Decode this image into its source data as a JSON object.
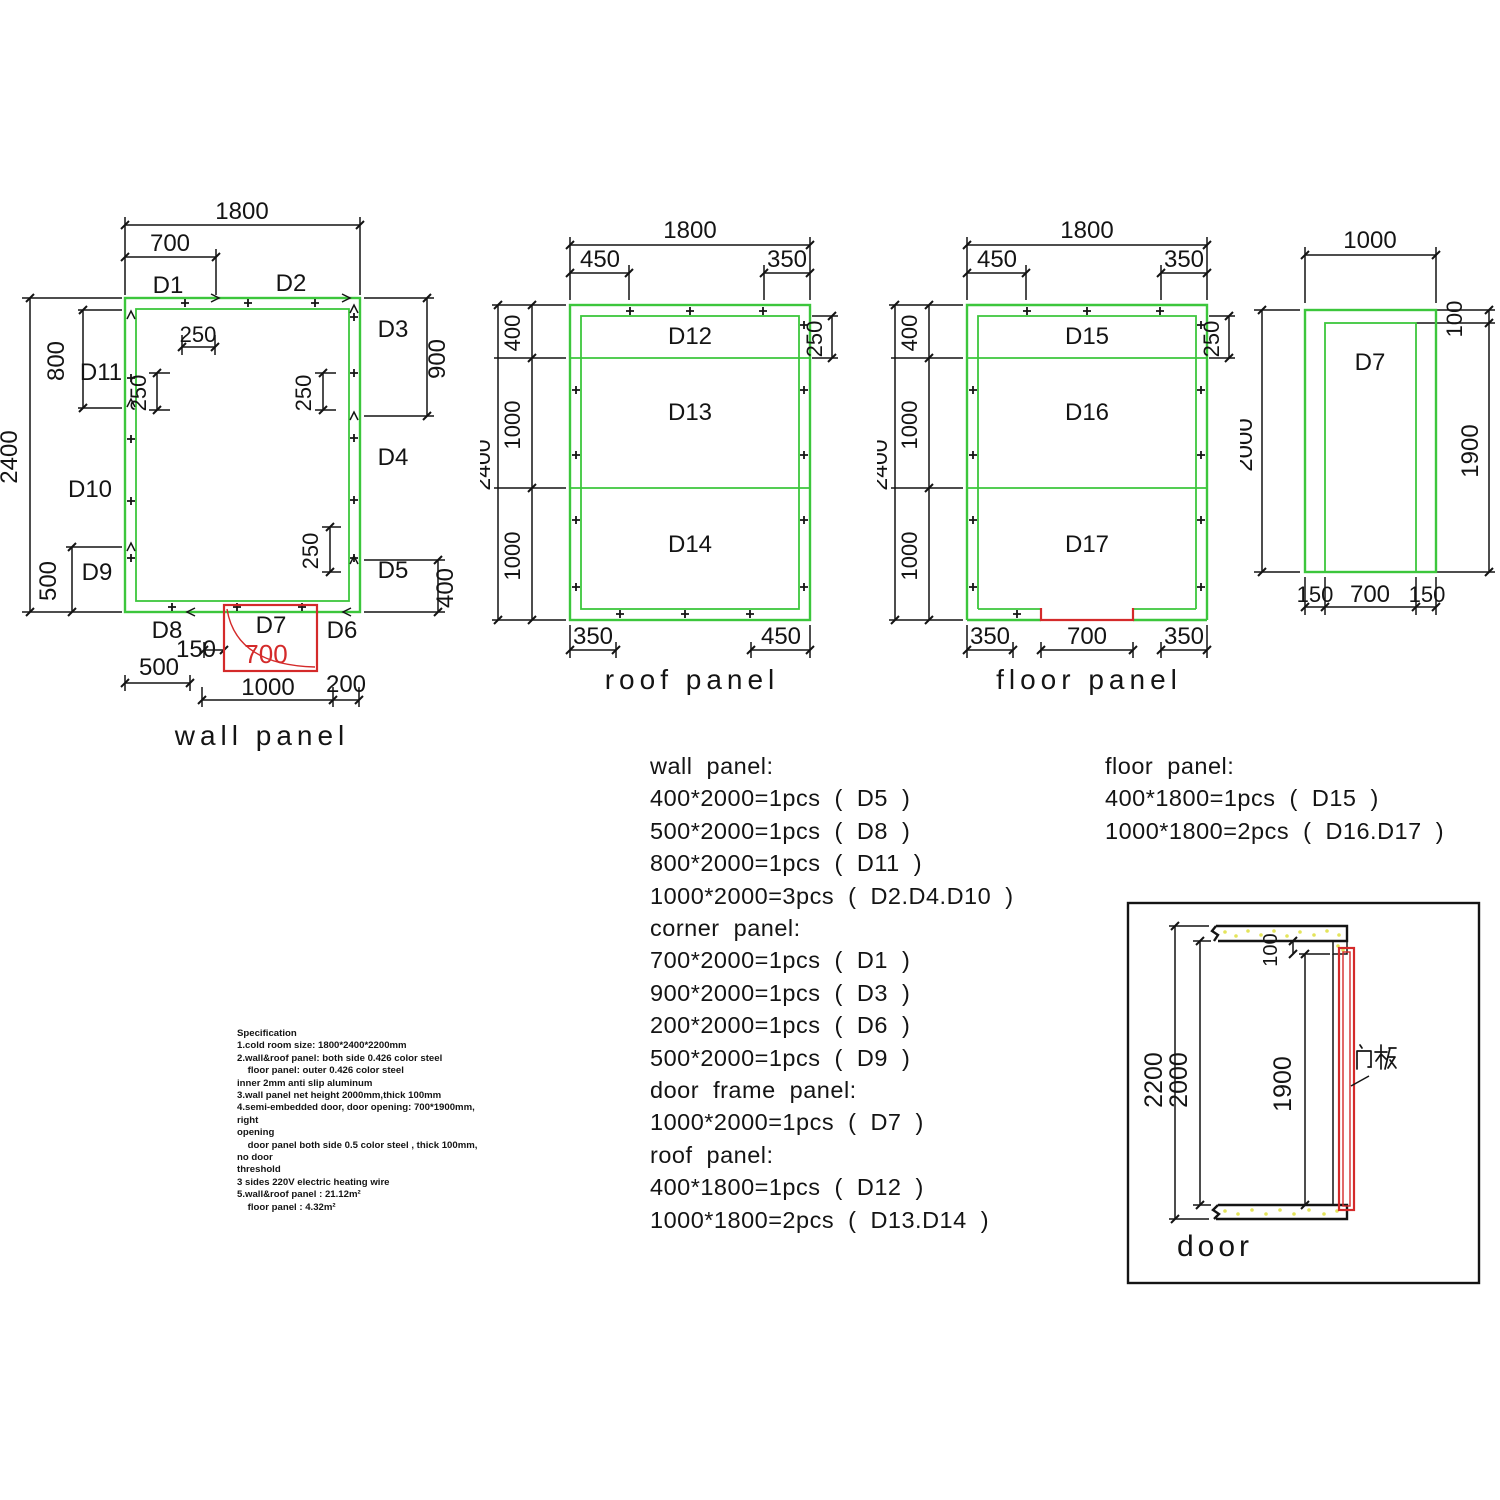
{
  "colors": {
    "panel_green": "#3cc63c",
    "door_red": "#d42a2a",
    "line_black": "#141414",
    "hatch_yellow": "#e4e45a"
  },
  "wall_panel": {
    "title": "wall panel",
    "dims": {
      "total_width": "1800",
      "d1_width": "700",
      "top_offset_250": "250",
      "left_800": "800",
      "left_total_2400": "2400",
      "left_250": "250",
      "right_250": "250",
      "right_900": "900",
      "left_500": "500",
      "lower_right_250": "250",
      "right_400": "400",
      "bottom_500": "500",
      "bottom_150": "150",
      "door_700": "700",
      "bottom_1000": "1000",
      "bottom_200": "200"
    },
    "labels": {
      "d1": "D1",
      "d2": "D2",
      "d3": "D3",
      "d4": "D4",
      "d5": "D5",
      "d6": "D6",
      "d7": "D7",
      "d8": "D8",
      "d9": "D9",
      "d10": "D10",
      "d11": "D11"
    }
  },
  "roof_panel": {
    "title": "roof panel",
    "dims": {
      "total_width": "1800",
      "top_left_450": "450",
      "top_right_350": "350",
      "left_total_2400": "2400",
      "left_400": "400",
      "left_1000_a": "1000",
      "left_1000_b": "1000",
      "right_250": "250",
      "bottom_left_350": "350",
      "bottom_right_450": "450"
    },
    "labels": {
      "d12": "D12",
      "d13": "D13",
      "d14": "D14"
    }
  },
  "floor_panel": {
    "title": "floor panel",
    "dims": {
      "total_width": "1800",
      "top_left_450": "450",
      "top_right_350": "350",
      "left_total_2400": "2400",
      "left_400": "400",
      "left_1000_a": "1000",
      "left_1000_b": "1000",
      "right_250": "250",
      "bottom_left_350": "350",
      "bottom_door_700": "700",
      "bottom_right_350": "350"
    },
    "labels": {
      "d15": "D15",
      "d16": "D16",
      "d17": "D17"
    }
  },
  "door_frame_panel": {
    "label": "D7",
    "dims": {
      "top_1000": "1000",
      "right_100": "100",
      "left_2000": "2000",
      "right_1900": "1900",
      "bottom_150_left": "150",
      "bottom_700": "700",
      "bottom_150_right": "150"
    }
  },
  "panel_lists": {
    "left": [
      "wall panel:",
      "400*2000=1pcs ( D5 )",
      "500*2000=1pcs ( D8 )",
      "800*2000=1pcs ( D11 )",
      "1000*2000=3pcs ( D2.D4.D10 )",
      "corner panel:",
      "700*2000=1pcs ( D1 )",
      "900*2000=1pcs ( D3 )",
      "200*2000=1pcs ( D6 )",
      "500*2000=1pcs ( D9 )",
      "door frame panel:",
      "1000*2000=1pcs ( D7 )",
      "roof panel:",
      "400*1800=1pcs ( D12 )",
      "1000*1800=2pcs ( D13.D14 )"
    ],
    "right": [
      "floor panel:",
      "400*1800=1pcs ( D15 )",
      "1000*1800=2pcs ( D16.D17 )"
    ]
  },
  "specification": {
    "lines": [
      "Specification",
      "1.cold room size: 1800*2400*2200mm",
      "2.wall&roof panel: both side 0.426 color steel",
      "    floor panel: outer 0.426 color steel",
      "inner 2mm anti slip aluminum",
      "3.wall panel net height 2000mm,thick 100mm",
      "4.semi-embedded door, door opening: 700*1900mm,",
      "right",
      "opening",
      "    door panel both side 0.5 color steel , thick 100mm,",
      "no door",
      "threshold",
      "3 sides 220V electric heating wire",
      "5.wall&roof panel : 21.12m²",
      "    floor panel : 4.32m²"
    ]
  },
  "door_section": {
    "title": "door",
    "door_panel_label_cn": "门板",
    "dims": {
      "outer_2200": "2200",
      "inner_2000": "2000",
      "opening_1900": "1900",
      "top_100": "100"
    }
  }
}
